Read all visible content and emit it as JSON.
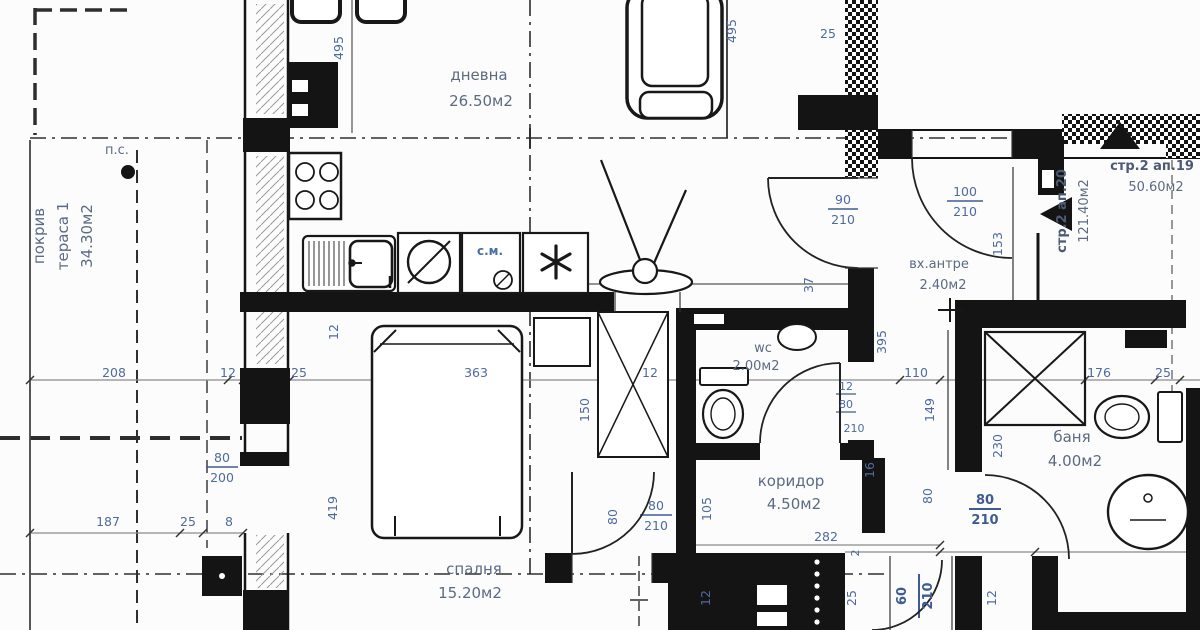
{
  "colors": {
    "background": "#fcfcfc",
    "line": "#161616",
    "dim_line": "#8a8a8a",
    "dim_text": "#4e6b9d",
    "dim_text_bold": "#3e5c92",
    "room_text": "#5c6a82"
  },
  "rooms": {
    "dnevna": {
      "name": "дневна",
      "area": "26.50м2"
    },
    "terasa": {
      "line1": "покрив",
      "line2": "тераса 1",
      "area": "34.30м2"
    },
    "spalnya": {
      "name": "спалня",
      "area": "15.20м2"
    },
    "wc": {
      "name": "wc",
      "area": "2.00м2"
    },
    "koridor": {
      "name": "коридор",
      "area": "4.50м2"
    },
    "antre": {
      "name": "вх.антре",
      "area": "2.40м2"
    },
    "banya": {
      "name": "баня",
      "area": "4.00м2"
    },
    "ap19": {
      "name": "стр.2 ап.19",
      "area": "50.60м2"
    },
    "ap20": {
      "name": "стр.2 ап.20",
      "area": "121.40м2"
    }
  },
  "annotations": {
    "ps": "п.с.",
    "sm": "с.м."
  },
  "dims": {
    "n495": "495",
    "n208": "208",
    "n363": "363",
    "n110": "110",
    "n176": "176",
    "n150": "150",
    "n419": "419",
    "n395": "395",
    "n153": "153",
    "n149": "149",
    "n230": "230",
    "n282": "282",
    "n187": "187",
    "n105": "105",
    "n100": "100",
    "n200": "200",
    "n210": "210",
    "n90": "90",
    "n80": "80",
    "n60": "60",
    "n37": "37",
    "n25": "25",
    "n16": "16",
    "n12": "12",
    "n8": "8",
    "n2": "2"
  }
}
